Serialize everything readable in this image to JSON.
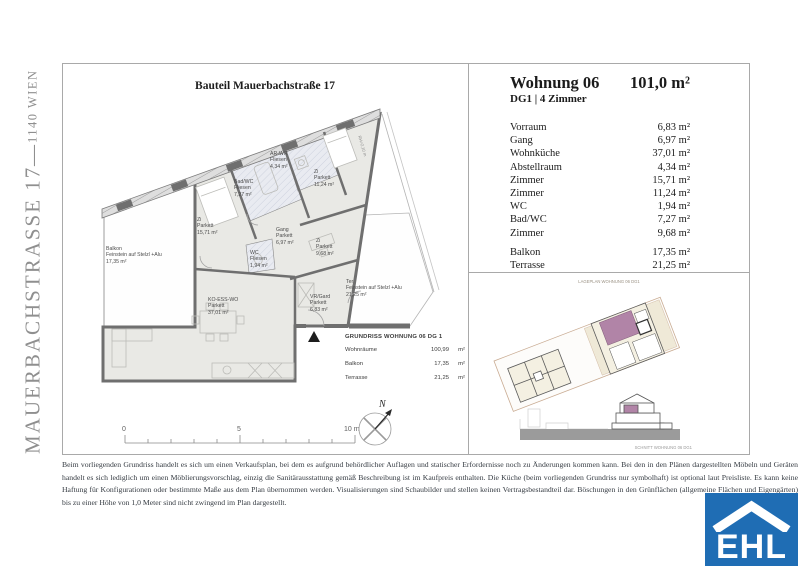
{
  "side_title": {
    "main": "MAUERBACHSTRASSE 17",
    "separator": " — ",
    "sub": "1140 WIEN"
  },
  "plan": {
    "title": "Bauteil Mauerbachstraße 17",
    "rh_label": "RH=2,10 m",
    "rooms": [
      {
        "id": "balkon",
        "lines": [
          "Balkon",
          "Feinstein auf Stelzl +Alu",
          "17,35 m²"
        ]
      },
      {
        "id": "zi1",
        "lines": [
          "Zi",
          "Parkett",
          "15,71 m²"
        ]
      },
      {
        "id": "badwc",
        "lines": [
          "Bad/WC",
          "Fliesen",
          "7,27 m²"
        ]
      },
      {
        "id": "arwr",
        "lines": [
          "AR-WR",
          "Fliesen",
          "4,34 m²"
        ]
      },
      {
        "id": "zi2",
        "lines": [
          "Zi",
          "Parkett",
          "11,24 m²"
        ]
      },
      {
        "id": "gang",
        "lines": [
          "Gang",
          "Parkett",
          "6,97 m²"
        ]
      },
      {
        "id": "wc",
        "lines": [
          "WC",
          "Fliesen",
          "1,94 m²"
        ]
      },
      {
        "id": "zi3",
        "lines": [
          "Zi",
          "Parkett",
          "9,68 m²"
        ]
      },
      {
        "id": "koesswo",
        "lines": [
          "KO-ESS-WO",
          "Parkett",
          "37,01 m²"
        ]
      },
      {
        "id": "vrgard",
        "lines": [
          "VR/Gard",
          "Parkett",
          "6,83 m²"
        ]
      },
      {
        "id": "ter",
        "lines": [
          "Ter",
          "Feinstein auf Stelzl +Alu",
          "21,25 m²"
        ]
      }
    ],
    "summary": {
      "title": "GRUNDRISS WOHNUNG 06 DG 1",
      "rows": [
        {
          "label": "Wohnräume",
          "value": "100,99",
          "unit": "m²"
        },
        {
          "label": "Balkon",
          "value": "17,35",
          "unit": "m²"
        },
        {
          "label": "Terrasse",
          "value": "21,25",
          "unit": "m²"
        }
      ]
    },
    "scale": {
      "t0": "0",
      "t5": "5",
      "t10": "10 m"
    },
    "north_label": "N"
  },
  "details": {
    "title": "Wohnung 06",
    "total_area": "101,0 m²",
    "subtitle": "DG1 | 4 Zimmer",
    "rooms": [
      {
        "label": "Vorraum",
        "area": "6,83 m²"
      },
      {
        "label": "Gang",
        "area": "6,97 m²"
      },
      {
        "label": "Wohnküche",
        "area": "37,01 m²"
      },
      {
        "label": "Abstellraum",
        "area": "4,34 m²"
      },
      {
        "label": "Zimmer",
        "area": "15,71 m²"
      },
      {
        "label": "Zimmer",
        "area": "11,24 m²"
      },
      {
        "label": "WC",
        "area": "1,94 m²"
      },
      {
        "label": "Bad/WC",
        "area": "7,27 m²"
      },
      {
        "label": "Zimmer",
        "area": "9,68 m²"
      }
    ],
    "outdoor": [
      {
        "label": "Balkon",
        "area": "17,35 m²"
      },
      {
        "label": "Terrasse",
        "area": "21,25 m²"
      }
    ],
    "siteplan_caption": "LAGEPLAN WOHNUNG 06 DG1",
    "section_caption": "SCHNITT WOHNUNG 06 DG1"
  },
  "footer": {
    "disclaimer": "Beim vorliegenden Grundriss handelt es sich um einen Verkaufsplan, bei dem es aufgrund behördlicher Auflagen und statischer Erfordernisse noch zu Änderungen kommen kann. Bei den in den Plänen dargestellten Möbeln und Geräten handelt es sich lediglich um einen Möblierungsvorschlag, einzig die Sanitärausstattung gemäß Beschreibung ist im Kaufpreis enthalten. Die Küche (beim vorliegenden Grundriss nur symbolhaft) ist optional laut Preisliste. Es kann keine Haftung für Konfigurationen oder bestimmte Maße aus dem Plan übernommen werden. Visualisierungen sind Schaubilder und stellen keinen Vertragsbestandteil dar. Böschungen in den Grünflächen (allgemeine Flächen und Eigengärten) bis zu einer Höhe von 1,0 Meter sind nicht zwingend im Plan dargestellt.",
    "logo_text": "EHL"
  },
  "colors": {
    "logo_blue": "#1f6db4",
    "unit_highlight": "#b184a7",
    "wall": "#6f6f6f"
  }
}
